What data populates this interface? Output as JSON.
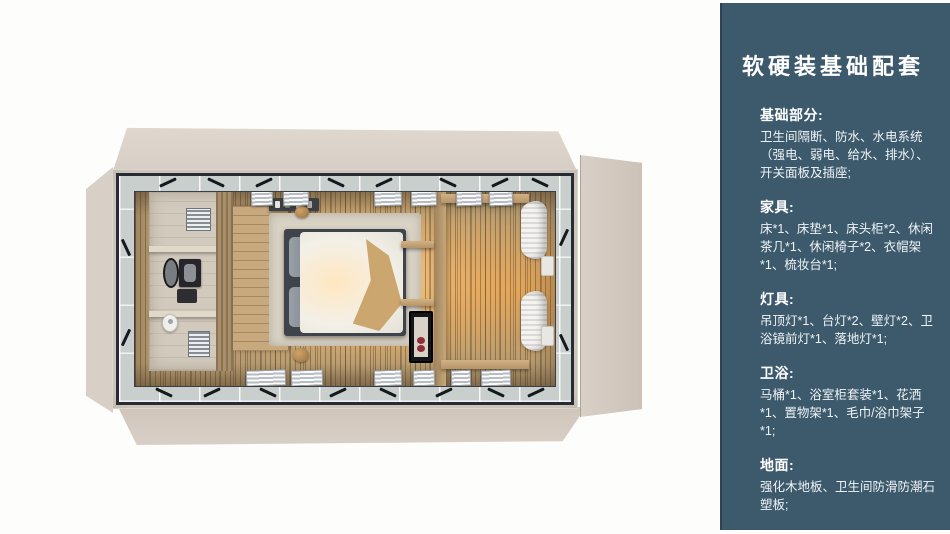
{
  "panel": {
    "title": "软硬装基础配套",
    "sections": [
      {
        "heading": "基础部分:",
        "body": "卫生间隔断、防水、水电系统（强电、弱电、给水、排水）、开关面板及插座;"
      },
      {
        "heading": "家具:",
        "body": "床*1、床垫*1、床头柜*2、休闲茶几*1、休闲椅子*2、衣帽架*1、梳妆台*1;"
      },
      {
        "heading": "灯具:",
        "body": "吊顶灯*1、台灯*2、壁灯*2、卫浴镜前灯*1、落地灯*1;"
      },
      {
        "heading": "卫浴:",
        "body": "马桶*1、浴室柜套装*1、花洒*1、置物架*1、毛巾/浴巾架子*1;"
      },
      {
        "heading": "地面:",
        "body": "强化木地板、卫生间防滑防潮石塑板;"
      }
    ]
  },
  "colors": {
    "panel_bg": "#3d5a6c",
    "panel_border": "#2c4353",
    "title_text": "#ffffff",
    "body_text": "#eef3f6",
    "shell": "#dbd3ca",
    "frame_steel": "#272c34",
    "glazing": "#c9cfcc",
    "floor_wood": "#b89d72",
    "glow": "#ffd6a0",
    "wood_shelf": "#c9a878",
    "bath": "#d2cabd"
  }
}
